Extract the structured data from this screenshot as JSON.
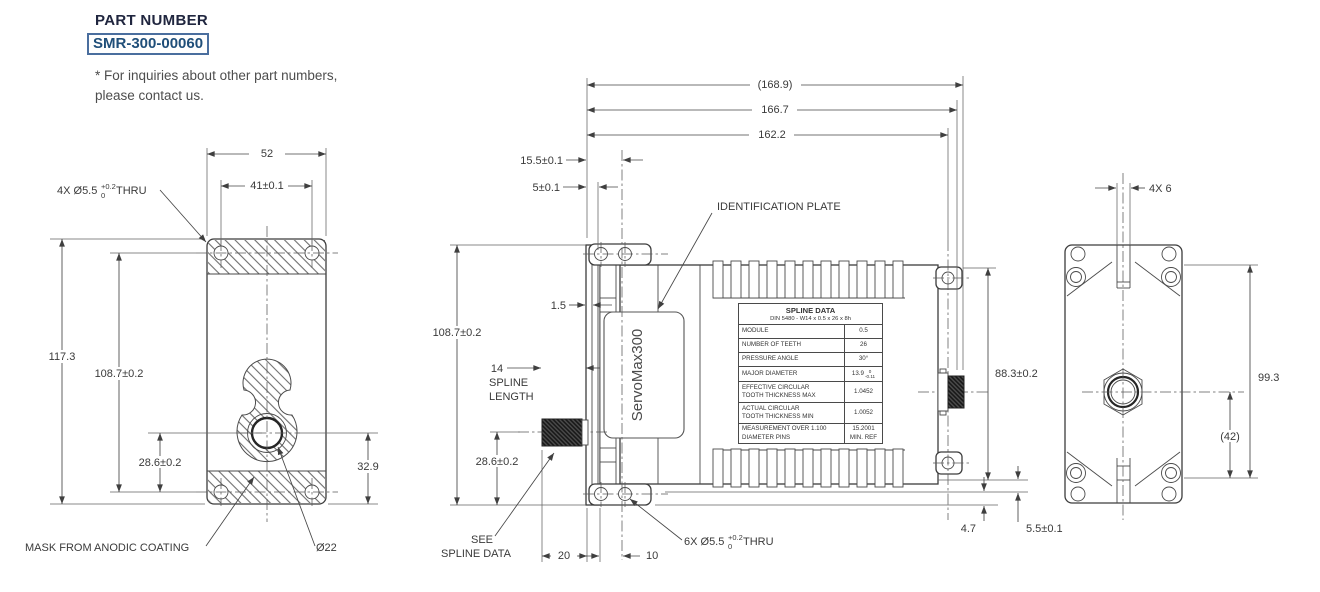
{
  "part_block": {
    "title": "PART NUMBER",
    "number": "SMR-300-00060",
    "note1": "* For inquiries about other part numbers,",
    "note2": "please contact us."
  },
  "front_view": {
    "dim_width": "52",
    "dim_holes_width": "41±0.1",
    "holes_label": "4X Ø5.5",
    "holes_tol_sup": "+0.2",
    "holes_tol_sub": "0",
    "holes_suffix": "THRU",
    "dim_height": "117.3",
    "dim_holes_height": "108.7±0.2",
    "dim_center": "28.6±0.2",
    "dim_bottom": "32.9",
    "mask_label": "MASK FROM ANODIC COATING",
    "bore_label": "Ø22"
  },
  "side_view": {
    "dim_total": "(168.9)",
    "dim_len2": "166.7",
    "dim_len3": "162.2",
    "dim_front": "15.5±0.1",
    "dim_flange": "5±0.1",
    "dim_plate": "1.5",
    "dim_height": "108.7±0.2",
    "spline_num": "14",
    "spline_word1": "SPLINE",
    "spline_word2": "LENGTH",
    "dim_shaft": "28.6±0.2",
    "see_word1": "SEE",
    "see_word2": "SPLINE DATA",
    "dim_20": "20",
    "dim_10": "10",
    "holes_label": "6X Ø5.5",
    "holes_tol_sup": "+0.2",
    "holes_tol_sub": "0",
    "holes_suffix": "THRU",
    "id_plate_label": "IDENTIFICATION PLATE",
    "brand": "ServoMax300",
    "dim_rear_height": "88.3±0.2",
    "dim_foot": "4.7",
    "dim_ear": "5.5±0.1"
  },
  "spline_table": {
    "title": "SPLINE DATA",
    "subtitle": "DIN 5480 - W14 x 0.5 x 26 x 8h",
    "r1_label": "MODULE",
    "r1_value": "0.5",
    "r2_label": "NUMBER OF TEETH",
    "r2_value": "26",
    "r3_label": "PRESSURE ANGLE",
    "r3_value": "30°",
    "r4_label": "MAJOR DIAMETER",
    "r4_value": "13.9",
    "r4_sup": "0",
    "r4_sub": "-0.11",
    "r5_label1": "EFFECTIVE CIRCULAR",
    "r5_label2": "TOOTH THICKNESS MAX",
    "r5_value": "1.0452",
    "r6_label1": "ACTUAL CIRCULAR",
    "r6_label2": "TOOTH THICKNESS MIN",
    "r6_value": "1.0052",
    "r7_label1": "MEASUREMENT OVER 1.100",
    "r7_label2": "DIAMETER PINS",
    "r7_value1": "15.2001",
    "r7_value2": "MIN. REF"
  },
  "rear_view": {
    "dim_slot": "4X 6",
    "dim_height": "99.3",
    "dim_conn": "(42)"
  }
}
